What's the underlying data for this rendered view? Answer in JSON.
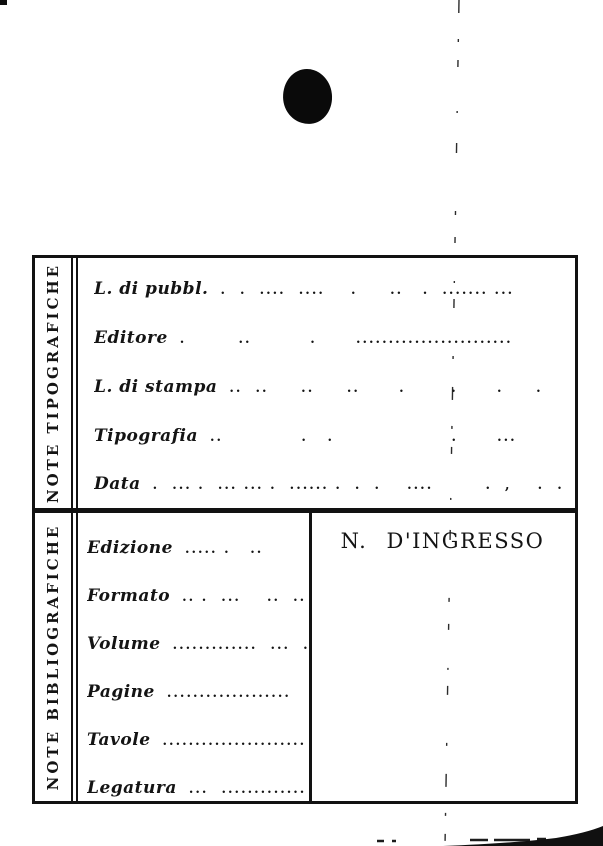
{
  "colors": {
    "ink": "#141414",
    "paper": "#ffffff"
  },
  "artifacts": {
    "punch_hole": "filled black circle (hole punch)",
    "fold_line": "vertical dashed crease",
    "corner_mark": "small ink mark top-left",
    "page_curl": "dark curl shadow bottom-right"
  },
  "card": {
    "sections": [
      {
        "sidebar_label": "NOTE TIPOGRAFICHE",
        "rows": [
          {
            "label": "L. di pubbl.",
            "leader": ".  .  ....  ....    .     ..   .  ....... ..."
          },
          {
            "label": "Editore",
            "leader": ".        ..         .      ........................"
          },
          {
            "label": "L. di stampa",
            "leader": "..  ..     ..     ..      .       .      .     .    ."
          },
          {
            "label": "Tipografia",
            "leader": "..            .   .                  .      ..."
          },
          {
            "label": "Data",
            "leader": ".  ... .  ... ... .  ...... .  .  .    ....        .  ,    .  ."
          }
        ]
      },
      {
        "sidebar_label": "NOTE BIBLIOGRAFICHE",
        "rows": [
          {
            "label": "Edizione",
            "leader": "..... .   ..         ."
          },
          {
            "label": "Formato",
            "leader": ".. .  ...    ..  ..  ..."
          },
          {
            "label": "Volume",
            "leader": ".............  ...  ."
          },
          {
            "label": "Pagine",
            "leader": "..................."
          },
          {
            "label": "Tavole",
            "leader": "......................"
          },
          {
            "label": "Legatura",
            "leader": "...  ..............."
          }
        ],
        "ingresso_title": "N. D'INGRESSO"
      }
    ]
  }
}
